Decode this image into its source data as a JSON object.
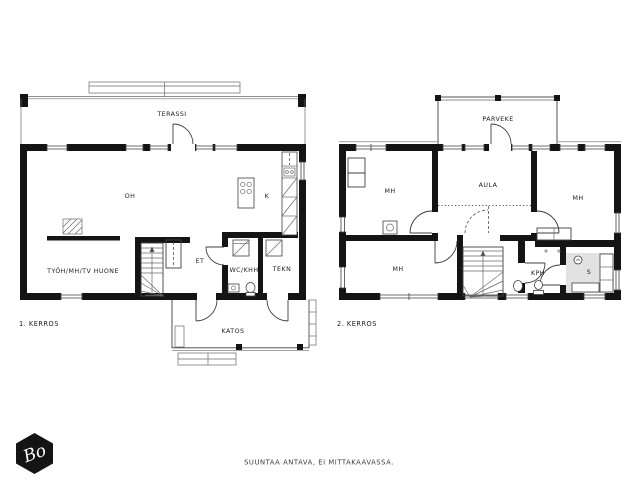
{
  "document": {
    "footer_note": "SUUNTAA ANTAVA, EI MITTAKAAVASSA.",
    "logo_monogram": "Bo"
  },
  "floor1": {
    "title": "1. KERROS",
    "rooms": {
      "terassi": "TERASSI",
      "oh": "OH",
      "kitchen": "K",
      "workroom": "TYÖH/MH/TV HUONE",
      "entry": "ET",
      "wc_utility": "WC/KHH",
      "technical": "TEKN",
      "canopy": "KATOS"
    }
  },
  "floor2": {
    "title": "2. KERROS",
    "rooms": {
      "parveke": "PARVEKE",
      "bedroom_left": "MH",
      "aula": "AULA",
      "bedroom_right": "MH",
      "bedroom_lower": "MH",
      "bathroom": "KPH",
      "sauna": "S"
    }
  },
  "colors": {
    "wall": "#141414",
    "line": "#3f3f3f",
    "sauna_floor": "#e2e2e2",
    "background": "#ffffff",
    "text": "#1c1c1c"
  }
}
